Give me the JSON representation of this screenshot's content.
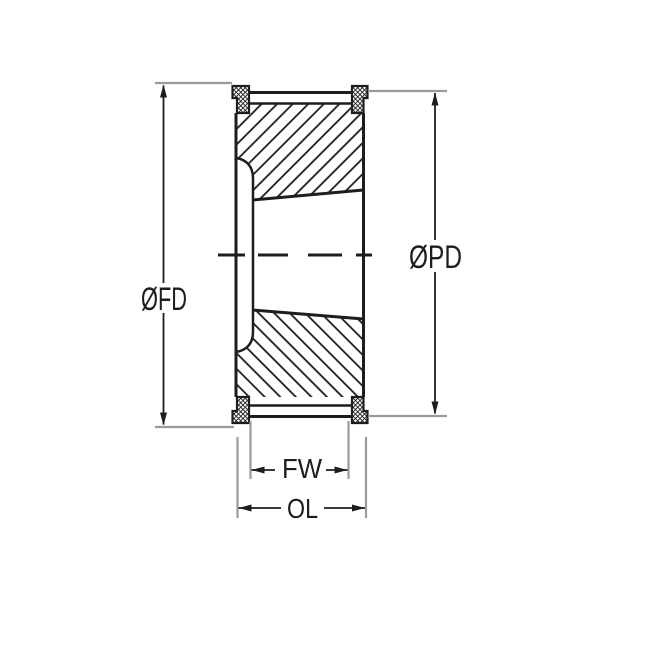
{
  "diagram": {
    "type": "technical-drawing",
    "subject": "timing-pulley-taper-bore-cross-section",
    "labels": {
      "flange_diameter": "ØFD",
      "pitch_diameter": "ØPD",
      "face_width": "FW",
      "overall_length": "OL"
    },
    "colors": {
      "line": "#1d1d1d",
      "extension_line": "#9b9b9b",
      "background": "#ffffff"
    }
  }
}
